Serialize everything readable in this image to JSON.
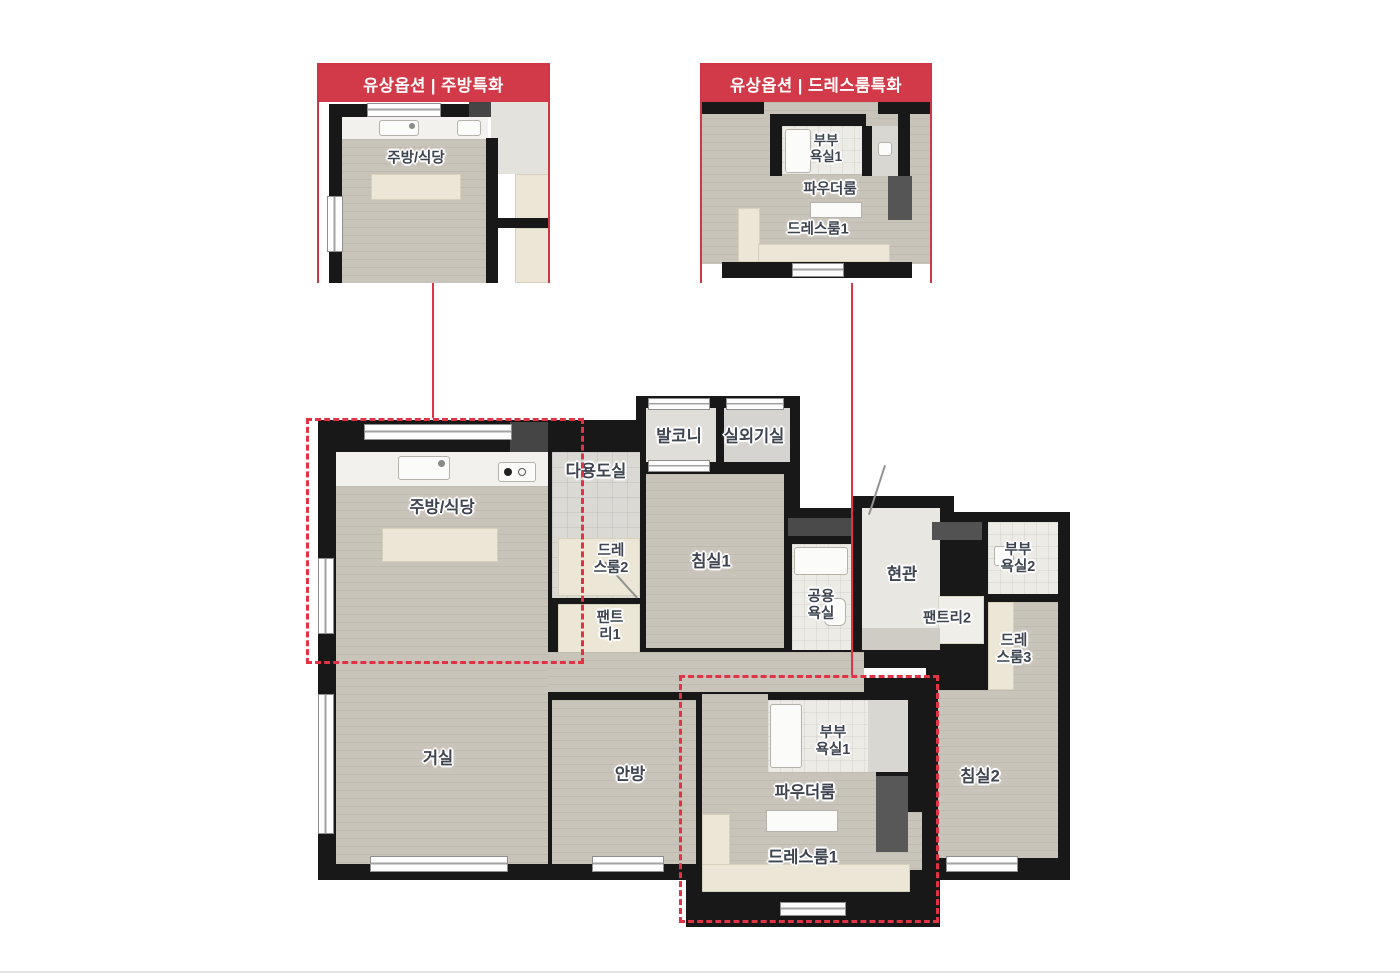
{
  "insets": {
    "kitchen": {
      "title": "유상옵션 | 주방특화",
      "room_label": "주방/식당"
    },
    "dressroom": {
      "title": "유상옵션 | 드레스룸특화",
      "labels": {
        "couple_bath1": "부부\n욕실1",
        "powder_room": "파우더룸",
        "dressroom1": "드레스룸1"
      }
    }
  },
  "plan": {
    "labels": {
      "kitchen": "주방/식당",
      "utility": "다용도실",
      "balcony": "발코니",
      "outdoor_unit": "실외기실",
      "bedroom1": "침실1",
      "dressroom2": "드레\n스룸2",
      "pantry1": "팬트\n리1",
      "common_bath": "공용\n욕실",
      "entrance": "현관",
      "pantry2": "팬트리2",
      "couple_bath2": "부부\n욕실2",
      "dressroom3": "드레\n스룸3",
      "living": "거실",
      "master_bedroom": "안방",
      "couple_bath1": "부부\n욕실1",
      "powder_room": "파우더룸",
      "dressroom1": "드레스룸1",
      "bedroom2": "침실2"
    }
  },
  "palette": {
    "accent_red": "#d23a49",
    "dashed_red": "#e23245",
    "wall": "#181818",
    "wood_floor": "#c9c4ba",
    "tile_floor": "#dbd9d4",
    "bath_tile": "#edebe6",
    "cream_shelf": "#ebe6d5",
    "label_text": "#3e4450",
    "background": "#ffffff"
  }
}
